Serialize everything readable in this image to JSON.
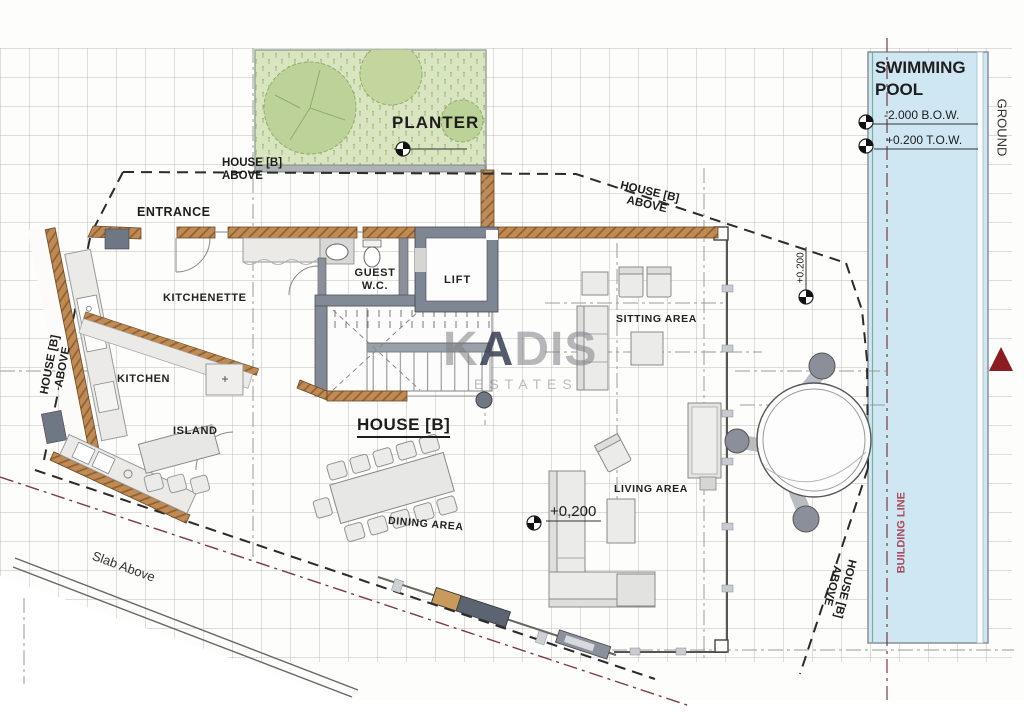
{
  "drawing": {
    "type": "architectural floor plan",
    "house_title": "HOUSE [B]",
    "house_above_line1": "HOUSE [B]",
    "house_above_line2": "ABOVE",
    "slab_above": "Slab Above",
    "building_line": "BUILDING LINE",
    "ground": "GROUND"
  },
  "rooms": {
    "entrance": "ENTRANCE",
    "kitchenette": "KITCHENETTE",
    "kitchen": "KITCHEN",
    "island": "ISLAND",
    "guest_wc_line1": "GUEST",
    "guest_wc_line2": "W.C.",
    "lift": "LIFT",
    "sitting_area": "SITTING AREA",
    "living_area": "LIVING AREA",
    "dining_area": "DINING AREA",
    "planter": "PLANTER"
  },
  "pool": {
    "name_line1": "SWIMMING",
    "name_line2": "POOL",
    "bottom_of_water": "-2.000 B.O.W.",
    "top_of_water": "+0.200 T.O.W."
  },
  "levels": {
    "living_level": "+0,200",
    "terrace_level": "+0.200"
  },
  "watermark": {
    "k": "K",
    "a": "A",
    "dis": "DIS",
    "estates": "ESTATES"
  },
  "colors": {
    "planter_green": "#d9e5c1",
    "tree_green": "#bdd298",
    "pool_blue": "#cfe7f2",
    "wall_brown": "#c08a52",
    "wall_gray": "#7e8694",
    "boundary_maroon": "#7b3a42",
    "marker_red": "#8b1d20",
    "building_line_text": "#a84b5c"
  }
}
